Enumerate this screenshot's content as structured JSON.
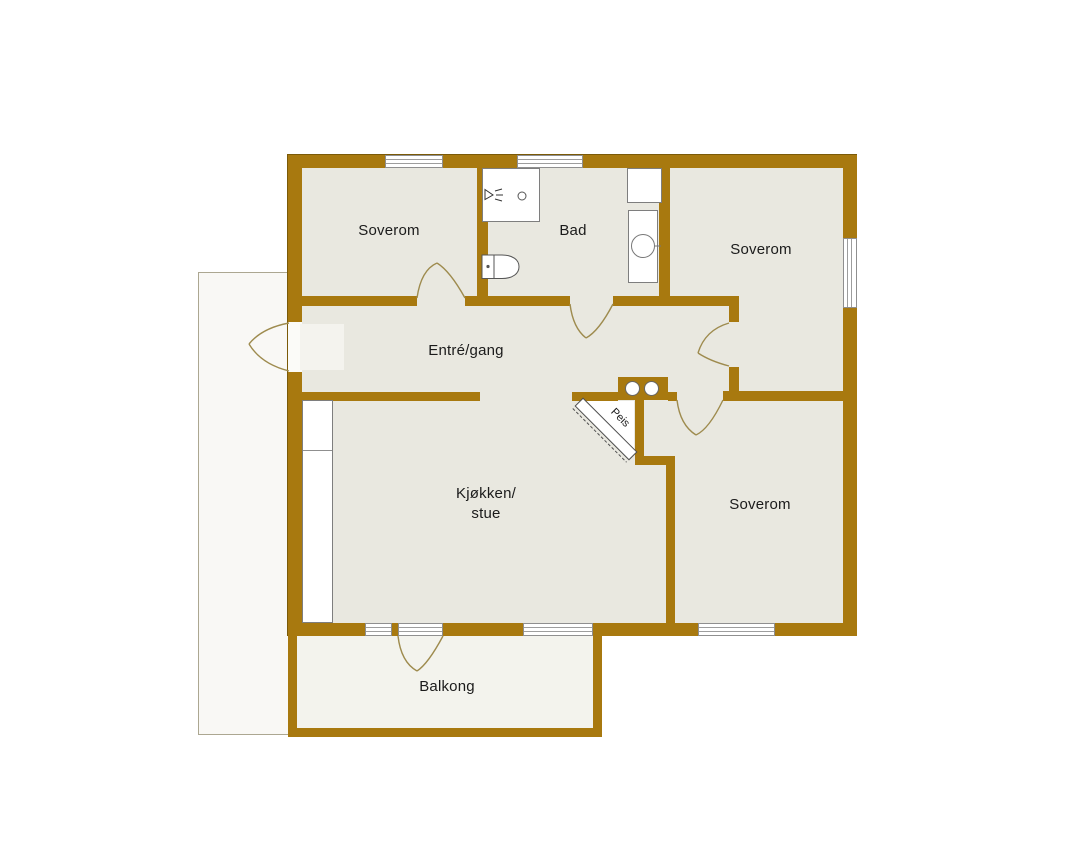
{
  "floorplan": {
    "labels": {
      "bedroom_top_left": "Soverom",
      "bathroom": "Bad",
      "bedroom_top_right": "Soverom",
      "hallway": "Entré/gang",
      "kitchen_living": "Kjøkken/\nstue",
      "bedroom_bottom_right": "Soverom",
      "balcony": "Balkong",
      "fireplace": "Peis"
    },
    "colors": {
      "wall": "#A8790F",
      "room_fill": "#E9E8E0",
      "balcony_fill": "#F3F3ED",
      "terrace_fill": "#F9F8F5",
      "door_swing": "#9E8B4E",
      "label_text": "#1B1B1B"
    }
  }
}
